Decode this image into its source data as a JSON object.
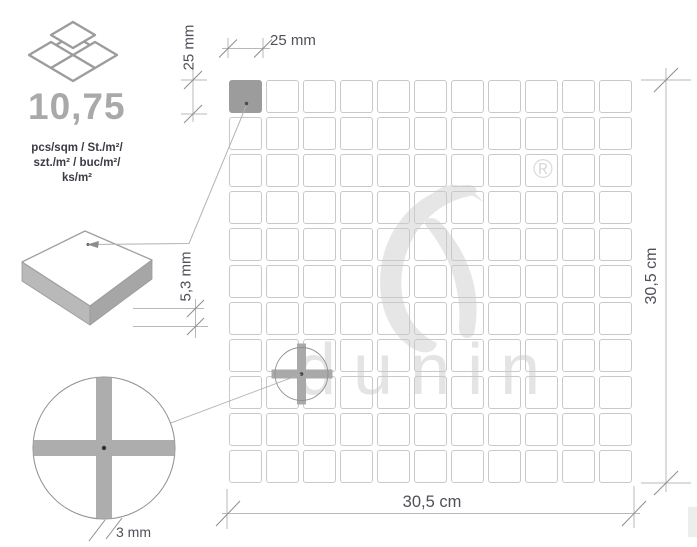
{
  "product": {
    "density": "10,75",
    "units": [
      "pcs/sqm / St./m²/",
      "szt./m² / buc/m²/",
      "ks/m²"
    ]
  },
  "dimensions": {
    "chip_width_label": "25 mm",
    "chip_height_label": "25 mm",
    "thickness_label": "5,3 mm",
    "joint_label": "3 mm",
    "sheet_width_label": "30,5 cm",
    "sheet_height_label": "30,5 cm"
  },
  "grid": {
    "rows": 11,
    "cols": 11,
    "highlighted": {
      "row": 0,
      "col": 0
    }
  },
  "watermark": {
    "brand": "dunin",
    "registered_mark": "®"
  },
  "colors": {
    "chip_highlight": "#9c9c9c",
    "grid_line": "#c9c9c9",
    "dimension_line": "#b8b8b8",
    "tick": "#8d8d8d",
    "watermark": "#e4e4e4"
  }
}
